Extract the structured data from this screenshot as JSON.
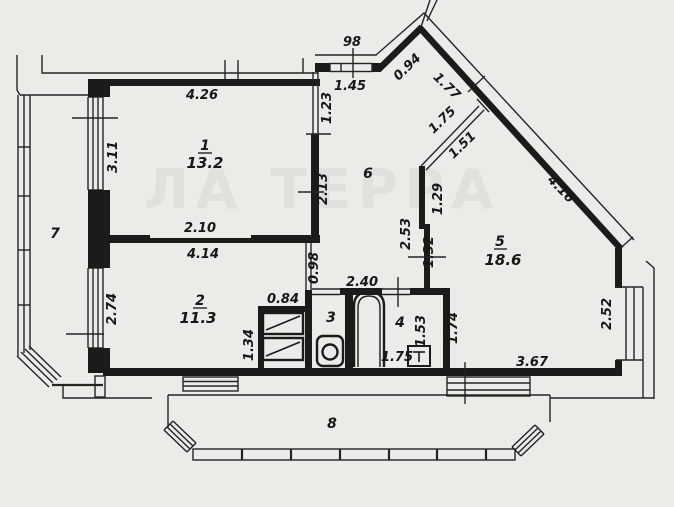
{
  "watermark": "ЛА ТЕРРА",
  "colors": {
    "background": "#ebebe8",
    "line": "#1b1b1b",
    "watermark": "#e0e0dd"
  },
  "rooms": {
    "room1": {
      "number": "1",
      "area": "13.2"
    },
    "room2": {
      "number": "2",
      "area": "11.3"
    },
    "room3": {
      "number": "3"
    },
    "room4": {
      "number": "4"
    },
    "room5": {
      "number": "5",
      "area": "18.6"
    },
    "room6": {
      "number": "6"
    },
    "room7": {
      "number": "7"
    },
    "room8": {
      "number": "8"
    }
  },
  "dims": {
    "top_width": "4.26",
    "room1_height": "3.11",
    "room1_opening": "2.10",
    "room1_right_upper": "1.23",
    "room1_right_lower": "2.13",
    "room2_width": "4.14",
    "room2_height": "2.74",
    "entrance_door": "98",
    "entrance_wall": "1.45",
    "diag_short": "0.94",
    "diag_mid": "1.77",
    "diag_long": "4.16",
    "passage_hall_side": "1.75",
    "passage_room_side": "1.51",
    "room5_wall_upper": "1.29",
    "hall_wall": "2.53",
    "room5_wall_lower": "1.32",
    "room2_door": "0.98",
    "hall_width": "2.40",
    "closet_width": "0.84",
    "closet_depth": "1.34",
    "bath_depth": "1.53",
    "bath_width": "1.75",
    "room5_west": "1.74",
    "room5_window": "2.52",
    "room5_south": "3.67"
  }
}
